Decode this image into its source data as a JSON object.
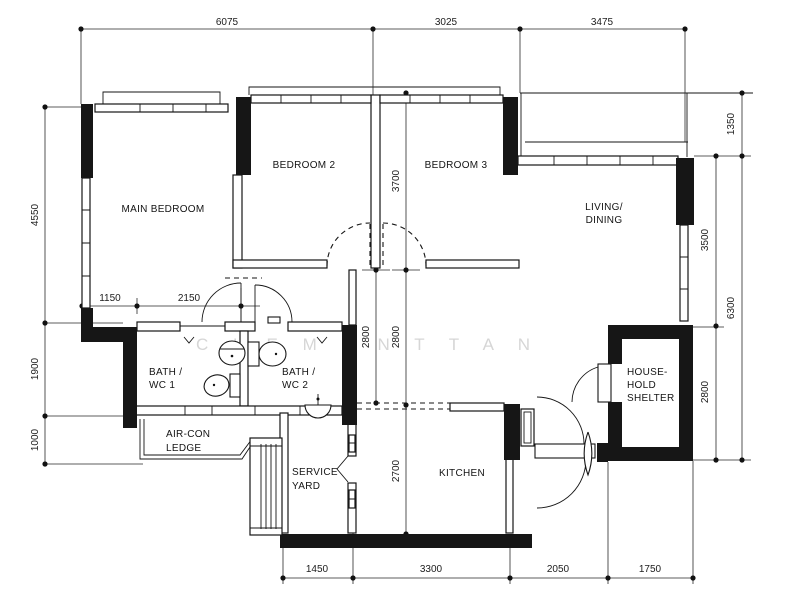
{
  "plan": {
    "title": "3-room flat floor plan",
    "watermark": "C L E M E N T   T A N",
    "watermark_color": "#d6d6d6",
    "ink_color": "#161616",
    "rooms": {
      "main_bedroom": "MAIN BEDROOM",
      "bedroom2": "BEDROOM 2",
      "bedroom3": "BEDROOM 3",
      "living1": "LIVING/",
      "living2": "DINING",
      "bath1a": "BATH /",
      "bath1b": "WC 1",
      "bath2a": "BATH /",
      "bath2b": "WC 2",
      "aircon1": "AIR-CON",
      "aircon2": "LEDGE",
      "service1": "SERVICE",
      "service2": "YARD",
      "kitchen": "KITCHEN",
      "shelter1": "HOUSE-",
      "shelter2": "HOLD",
      "shelter3": "SHELTER"
    },
    "dims": {
      "top": [
        "6075",
        "3025",
        "3475"
      ],
      "left": [
        "4550",
        "1900",
        "1000"
      ],
      "right": [
        "1350",
        "6300",
        "3500",
        "2800"
      ],
      "bottom": [
        "1450",
        "3300",
        "2050",
        "1750"
      ],
      "inner": [
        "1150",
        "2150",
        "3700",
        "2800",
        "2800",
        "2700"
      ]
    }
  }
}
